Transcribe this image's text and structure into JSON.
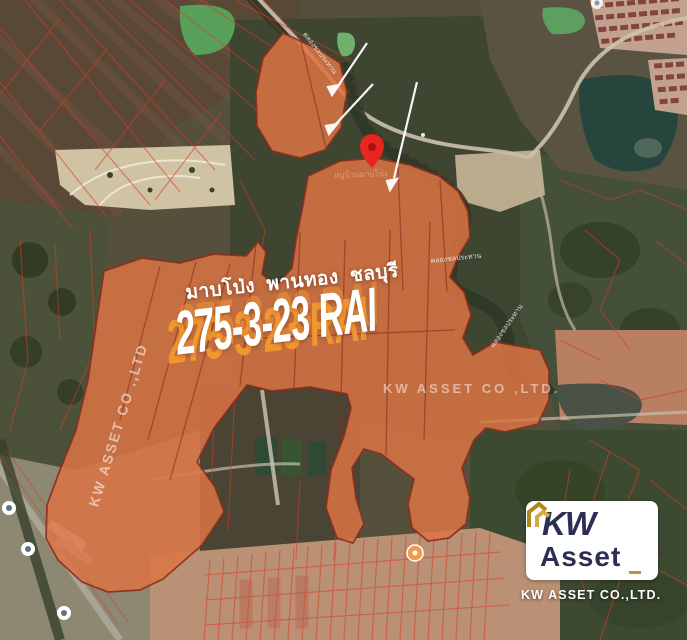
{
  "overlay": {
    "location_line": "มาบโป่ง  พานทอง  ชลบุรี",
    "area_text": "275-3-23 RAI",
    "watermark_center": "KW ASSET CO ,LTD.",
    "watermark_side": "KW ASSET CO .,LTD"
  },
  "map_labels": {
    "canal_top": "คลองชลประทาน",
    "canal_mid": "คลองชลประทาน",
    "canal_right": "คลองชลประทาน",
    "place_near_pin": "หมู่บ้านมาบโป่ง"
  },
  "logo": {
    "line1": "KW",
    "line2": "Asset",
    "company": "KW ASSET CO.,LTD."
  },
  "colors": {
    "parcel_fill": "#db7444",
    "parcel_stroke": "#8a2c1c",
    "cadastral_red": "#d93a25",
    "area_text_shadow": "#f59b2e",
    "logo_navy": "#2b3053",
    "logo_gold": "#c3922e"
  }
}
